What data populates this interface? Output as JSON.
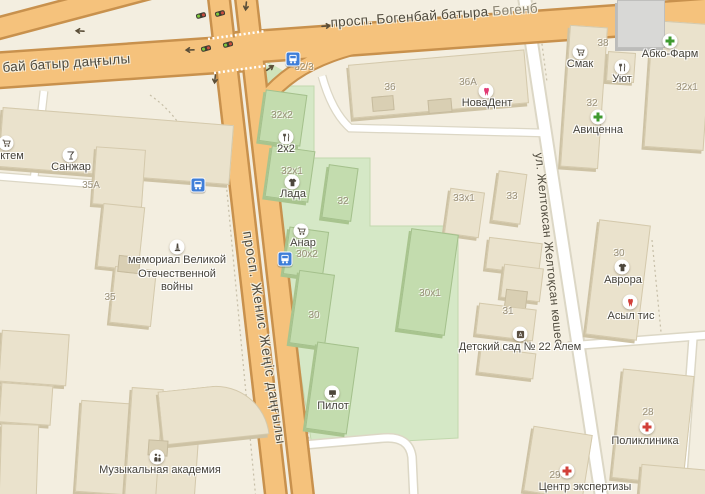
{
  "streets": [
    {
      "label": "просп. Богенбай батыра",
      "label_alt": "Бөгенб"
    },
    {
      "label": "бай батыр даңғылы"
    },
    {
      "label": "просп. Женис Жеңіс даңғылы"
    },
    {
      "label": "ул. Желтоксан Желтоқсан көшесі"
    }
  ],
  "building_numbers": [
    {
      "num": "36"
    },
    {
      "num": "36А"
    },
    {
      "num": "38"
    },
    {
      "num": "32"
    },
    {
      "num": "32х1"
    },
    {
      "num": "33х1"
    },
    {
      "num": "33"
    },
    {
      "num": "31"
    },
    {
      "num": "30"
    },
    {
      "num": "28"
    },
    {
      "num": "29"
    },
    {
      "num": "35А"
    },
    {
      "num": "35"
    },
    {
      "num": "32/3"
    },
    {
      "num": "32х2"
    },
    {
      "num": "32х1"
    },
    {
      "num": "32"
    },
    {
      "num": "30х2"
    },
    {
      "num": "30"
    },
    {
      "num": "30х1"
    }
  ],
  "pois": [
    {
      "label": "НоваДент",
      "icon": "tooth-icon"
    },
    {
      "label": "Смак",
      "icon": "cart-icon"
    },
    {
      "label": "Абко-Фарм",
      "icon": "green-cross-icon"
    },
    {
      "label": "Уют",
      "icon": "cutlery-icon"
    },
    {
      "label": "Авиценна",
      "icon": "green-cross-icon"
    },
    {
      "label": "Лада",
      "icon": "clothes-icon"
    },
    {
      "label": "2х2",
      "icon": "cutlery-icon"
    },
    {
      "label": "Анар",
      "icon": "cart-icon"
    },
    {
      "label": "Пилот",
      "icon": "monitor-icon"
    },
    {
      "label": "Аврора",
      "icon": "clothes-icon"
    },
    {
      "label": "Асыл тис",
      "icon": "tooth-icon"
    },
    {
      "label": "Детский сад № 22 Алем",
      "icon": "toy-cube-icon"
    },
    {
      "label": "Поликлиника",
      "icon": "red-cross-icon"
    },
    {
      "label": "Центр экспертизы",
      "icon": "red-cross-icon"
    },
    {
      "label": "мемориал Великой Отечественной войны",
      "icon": "monument-icon"
    },
    {
      "label": "Музыкальная академия",
      "icon": "people-icon"
    },
    {
      "label": "Санжар",
      "icon": "cocktail-icon"
    },
    {
      "label": "ктем",
      "icon": "cart-icon"
    }
  ],
  "transit": {
    "bus_stop_icon": "bus-icon",
    "traffic_light_icon": "traffic-light-icon"
  },
  "colors": {
    "background": "#f3eee0",
    "road_orange": "#f5c27c",
    "road_casing": "#c8914d",
    "white_road": "#ffffff",
    "green_zone": "#d5e8c6",
    "building_tan": "#eae2cc",
    "building_green": "#c3dcae",
    "building_gray": "#d8d8d6",
    "pharmacy_green": "#3f9a2f",
    "medical_red": "#d2403a",
    "dental_pink": "#e23a74",
    "bus_blue": "#3f7ed8"
  }
}
